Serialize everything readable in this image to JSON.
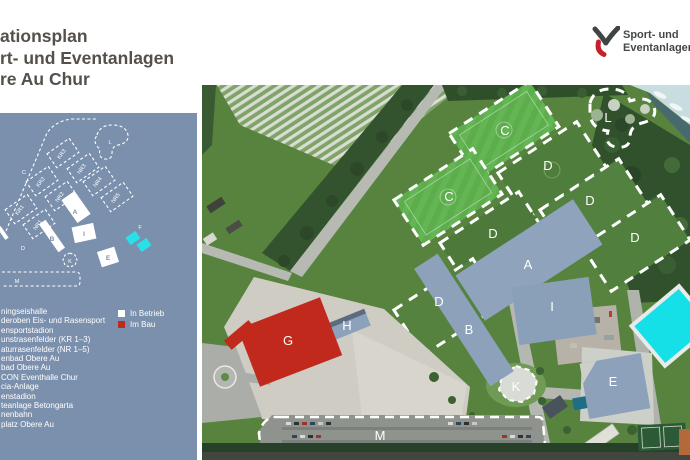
{
  "title": {
    "lines": [
      "ationsplan",
      "rt- und Eventanlagen",
      "re Au Chur"
    ]
  },
  "logo": {
    "lines": [
      "Sport- und",
      "Eventanlagen"
    ]
  },
  "sidebar": {
    "minimap_labels": [
      "C",
      "L",
      "KR3",
      "NR3",
      "KR2",
      "NR4",
      "NR2",
      "NR5",
      "KR1",
      "NR1",
      "A",
      "I",
      "B",
      "D",
      "K",
      "E",
      "F",
      "M"
    ],
    "legend_items": [
      "ningseishalle",
      "deroben Eis- und Rasensport",
      "ensportstadion",
      "unstrasenfelder (KR 1–3)",
      "aturrasenfelder (NR 1–5)",
      "enbad Obere Au",
      "bad Obere Au",
      "CON Eventhalle Chur",
      "cia-Anlage",
      "enstadion",
      "teanlage Betongarta",
      "nenbahn",
      "platz Obere Au"
    ],
    "legend_keys": [
      {
        "label": "In Betrieb",
        "color": "#ffffff"
      },
      {
        "label": "Im Bau",
        "color": "#c1291d"
      }
    ]
  },
  "map": {
    "zone_labels": [
      "C",
      "D",
      "C",
      "D",
      "D",
      "D",
      "D",
      "L",
      "A",
      "I",
      "B",
      "H",
      "G",
      "E",
      "K",
      "M"
    ]
  },
  "colors": {
    "sidebar_bg": "#7b90ac",
    "status_in_betrieb": "#ffffff",
    "status_im_bau": "#c1291d",
    "building_blue": "#8da2ba",
    "pool_cyan": "#15dfe7",
    "logo_red": "#c8202b"
  }
}
